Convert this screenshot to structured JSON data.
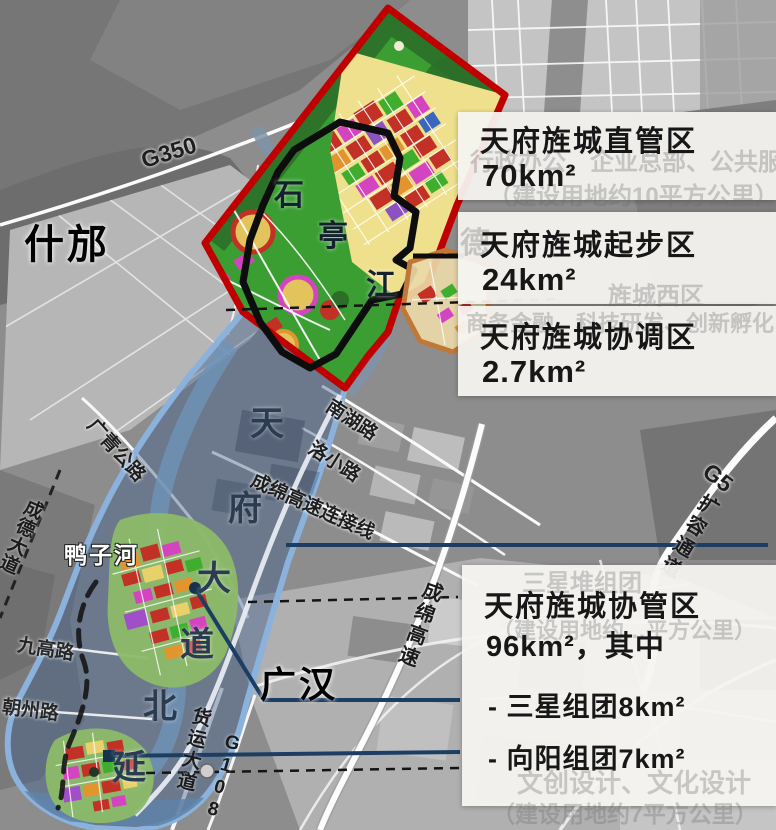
{
  "labels": {
    "cities": {
      "shifang": "什邡",
      "guanghan": "广汉"
    },
    "rivers": {
      "yazihe": "鸭子河",
      "shiting": [
        "石",
        "亭",
        "江"
      ]
    },
    "roads": {
      "g350": "G350",
      "nanhu": "南湖路",
      "luoxiao": "洛小路",
      "lianjie": "成绵高速连接线",
      "guangqing": "广青公路",
      "chengde": "成德大道",
      "jiugao": "九高路",
      "chaozhou": "朝州路",
      "chengmian": "成绵高速",
      "g5": "G5",
      "g5_corridor": "扩容通道",
      "huoyun": "货运大道",
      "g108": "G108",
      "tianfu_chars": [
        "天",
        "府",
        "大",
        "道",
        "北",
        "延"
      ]
    }
  },
  "callouts": {
    "zhiguan": {
      "title": "天府旌城直管区",
      "area": "70km²"
    },
    "qibu": {
      "title": "天府旌城起步区",
      "area": "24km²"
    },
    "xietiao": {
      "title": "天府旌城协调区",
      "area": "2.7km²"
    },
    "xieguan": {
      "title": "天府旌城协管区",
      "area": "96km²，其中",
      "items": [
        {
          "label": "- 三星组团8km²"
        },
        {
          "label": "- 向阳组团7km²"
        }
      ]
    }
  },
  "watermarks": {
    "wm1": "行政办公、企业总部、公共服务",
    "wm2": "（建设用地约10平方公里）",
    "wm3": "德",
    "wm4": "旌城西区",
    "wm5": "商务金融、科技研发、创新孵化",
    "wm6": "三星堆组团",
    "wm7": "（建设用地约…平方公里）",
    "wm8": "文创设计、文化设计",
    "wm9": "（建设用地约7平方公里）"
  },
  "colors": {
    "red_boundary": "#c00000",
    "black_boundary": "#0d0d0d",
    "orange_boundary": "#c07838",
    "blue_corridor_stroke": "#8ab2dc",
    "blue_corridor_fill": "rgba(62,92,138,0.42)",
    "callout_line": "#1c3e63",
    "box_background": "#f5f4f1"
  }
}
